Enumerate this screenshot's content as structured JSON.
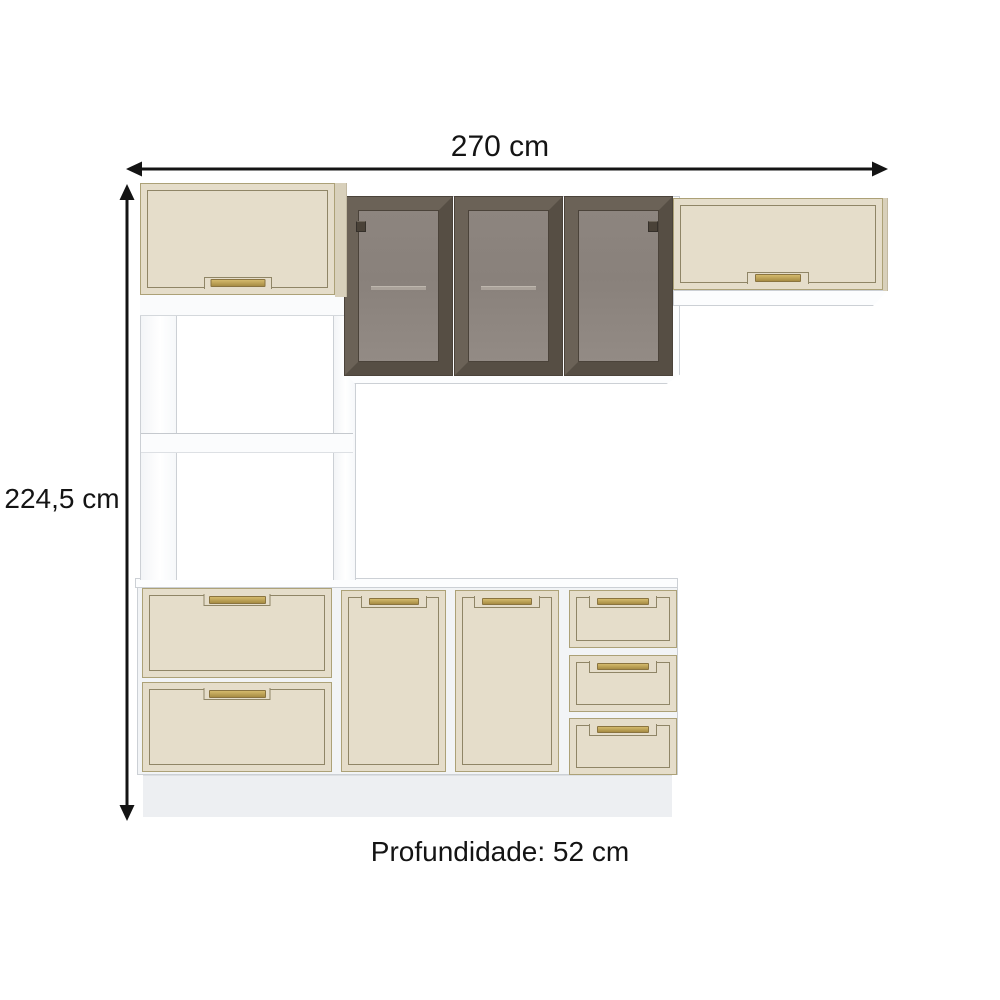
{
  "diagram": {
    "width_label": "270 cm",
    "height_label": "224,5 cm",
    "depth_label": "Profundidade: 52 cm"
  },
  "icons": {
    "width_arrow": "double-arrow-horizontal",
    "height_arrow": "double-arrow-vertical"
  },
  "colors": {
    "background": "#ffffff",
    "arrow": "#141414",
    "text": "#141414",
    "cream": "#e5ddca",
    "cream_dark": "#d8d0bb",
    "cream_trim": "#8f8566",
    "cream_edge": "#aca177",
    "handle_gold": "#bfa356",
    "handle_gold_dark": "#8a7440",
    "glass_frame": "#60574c",
    "glass_frame_dark": "#4b433a",
    "glass_pane": "#8c847e",
    "glass_shelf_line": "#aaa29a",
    "white_panel": "#fcfdfe",
    "white_panel_shade": "#f2f4f6",
    "panel_edge": "#ccd0d5",
    "plinth": "#edeff2"
  }
}
